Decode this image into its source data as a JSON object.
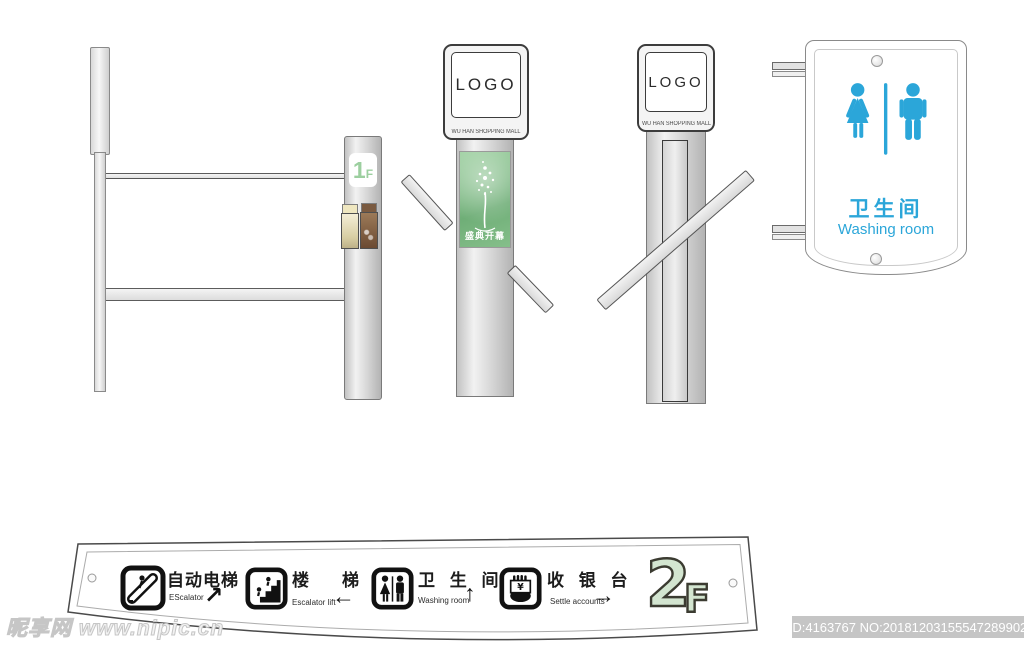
{
  "watermark": {
    "text": "昵享网 www.nipic.cn"
  },
  "footer": {
    "id_text": "ID:4163767 NO:20181203155547289902"
  },
  "colors": {
    "accent_blue": "#2BA6D9",
    "floor_green_fill": "#d3e5d0",
    "floor_green_text": "#9ccf9f",
    "poster_green": "#7dbe86"
  },
  "floor1": {
    "big": "1",
    "small": "F"
  },
  "pylon_front": {
    "logo": "LOGO",
    "subtitle": "WU HAN SHOPPING MALL",
    "poster_title": "盛典开幕"
  },
  "pylon_side": {
    "logo": "LOGO",
    "subtitle": "WU HAN SHOPPING MALL"
  },
  "washroom": {
    "cn": "卫生间",
    "en": "Washing room"
  },
  "directory": {
    "floor_big": "2",
    "floor_small": "F",
    "items": [
      {
        "cn": "自动电梯",
        "en": "EScalator",
        "arrow": "↗"
      },
      {
        "cn": "楼　梯",
        "en": "Escalator lift",
        "arrow": "←"
      },
      {
        "cn": "卫 生 间",
        "en": "Washing room",
        "arrow": "↑"
      },
      {
        "cn": "收 银 台",
        "en": "Settle accounts",
        "arrow": "→"
      }
    ]
  }
}
